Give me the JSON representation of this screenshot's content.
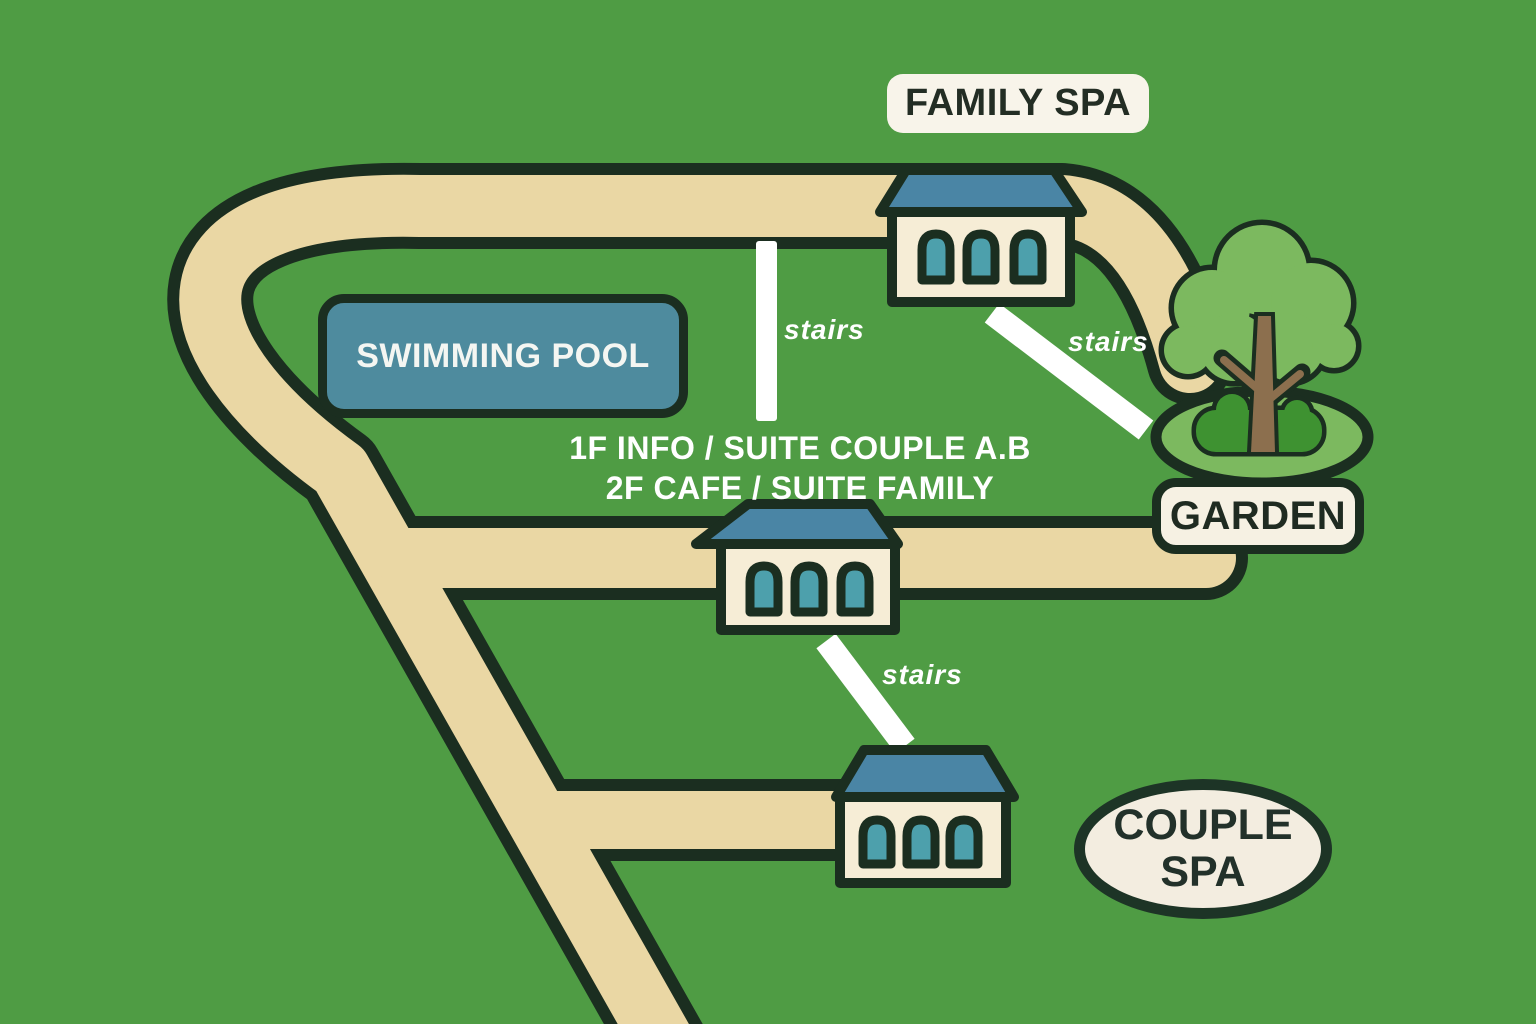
{
  "labels": {
    "family_spa": "FAMILY SPA",
    "swimming_pool": "SWIMMING POOL",
    "garden": "GARDEN",
    "couple_spa": [
      "COUPLE",
      "SPA"
    ],
    "info": [
      "1F INFO / SUITE COUPLE A.B",
      "2F CAFE / SUITE FAMILY"
    ],
    "stairs": [
      "stairs",
      "stairs",
      "stairs"
    ]
  },
  "icons": {
    "building": "house-icon",
    "garden_tree": "tree-icon",
    "stairs_marker": "stairs-line"
  },
  "colors": {
    "background": "#4f9c44",
    "road": "#ead7a4",
    "outline": "#1b2e20",
    "roof": "#4a85a5",
    "window": "#4da0ac",
    "house_wall": "#f6edd6",
    "pool": "#4e8b9e",
    "label_background": "#f6f1e3",
    "label_text": "#1f2b21",
    "foliage": "#7cb95f",
    "bush": "#3e9231",
    "trunk": "#8c6f4e",
    "stairs_line": "#ffffff"
  }
}
